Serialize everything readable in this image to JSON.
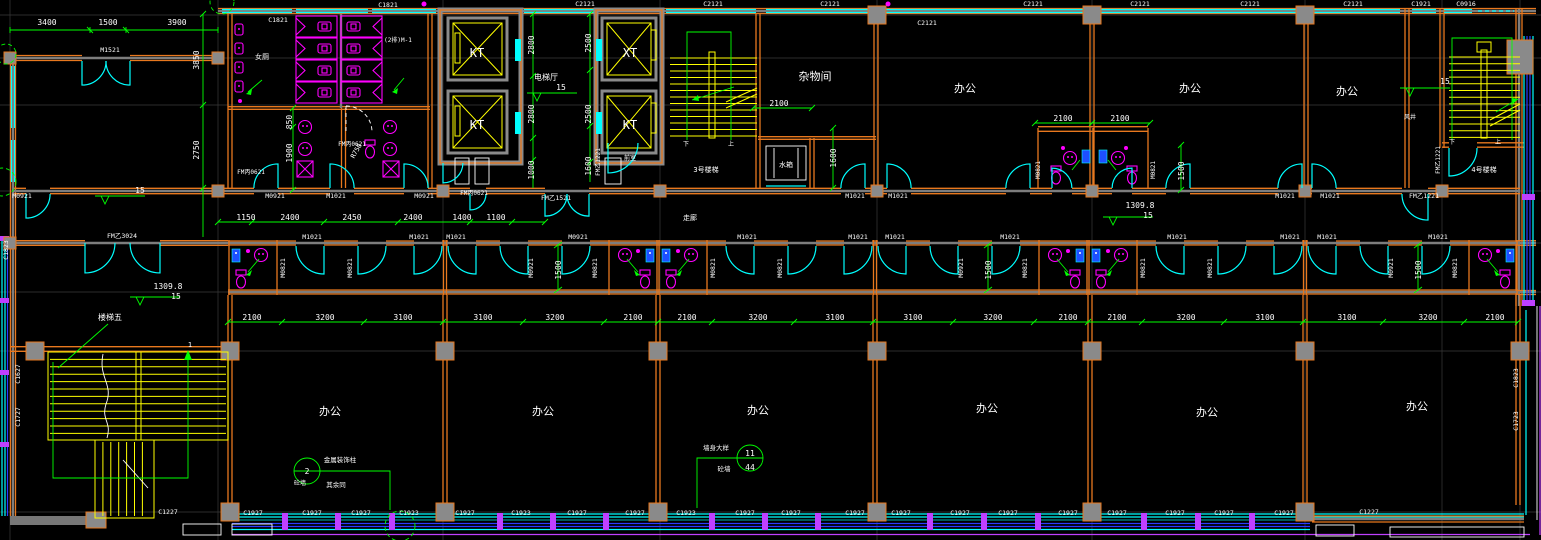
{
  "palette": {
    "background": "#000000",
    "wall_orange": "#E8781E",
    "wall_core_gray": "#8A8A8A",
    "window_cyan": "#00FFFF",
    "fixture_magenta": "#FF00FF",
    "dimension_green": "#00FF00",
    "stair_yellow": "#FFFF00",
    "text_white": "#FFFFFF",
    "curtain_blue": "#2B3BFF",
    "mullion_purple": "#BF40FF"
  },
  "drawing": {
    "type": "architectural-floor-plan",
    "rooms": [
      "办公",
      "杂物间",
      "电梯厅",
      "走廊",
      "水箱",
      "前室",
      "女厕",
      "风井",
      "3号楼梯",
      "4号楼梯",
      "楼梯五"
    ]
  },
  "labels": [
    {
      "t": "杂物间",
      "x": 815,
      "y": 80,
      "s": 11
    },
    {
      "t": "办公",
      "x": 965,
      "y": 92,
      "s": 11
    },
    {
      "t": "办公",
      "x": 1190,
      "y": 92,
      "s": 11
    },
    {
      "t": "办公",
      "x": 1347,
      "y": 95,
      "s": 11
    },
    {
      "t": "办公",
      "x": 330,
      "y": 415,
      "s": 11
    },
    {
      "t": "办公",
      "x": 543,
      "y": 415,
      "s": 11
    },
    {
      "t": "办公",
      "x": 758,
      "y": 414,
      "s": 11
    },
    {
      "t": "办公",
      "x": 987,
      "y": 412,
      "s": 11
    },
    {
      "t": "办公",
      "x": 1207,
      "y": 416,
      "s": 11
    },
    {
      "t": "办公",
      "x": 1417,
      "y": 410,
      "s": 11
    },
    {
      "t": "电梯厅",
      "x": 546,
      "y": 80,
      "s": 8
    },
    {
      "t": "3号楼梯",
      "x": 706,
      "y": 172,
      "s": 7
    },
    {
      "t": "4号楼梯",
      "x": 1484,
      "y": 172,
      "s": 7
    },
    {
      "t": "楼梯五",
      "x": 110,
      "y": 320,
      "s": 8
    },
    {
      "t": "水箱",
      "x": 786,
      "y": 167,
      "s": 7
    },
    {
      "t": "走廊",
      "x": 690,
      "y": 220,
      "s": 7
    },
    {
      "t": "女厕",
      "x": 262,
      "y": 59,
      "s": 7
    },
    {
      "t": "前室",
      "x": 630,
      "y": 160,
      "s": 6
    },
    {
      "t": "风井",
      "x": 1410,
      "y": 119,
      "s": 6
    },
    {
      "t": "(2排)M-1",
      "x": 398,
      "y": 42,
      "s": 6
    },
    {
      "t": "下",
      "x": 686,
      "y": 146,
      "s": 6
    },
    {
      "t": "上",
      "x": 731,
      "y": 146,
      "s": 6
    },
    {
      "t": "下",
      "x": 1452,
      "y": 144,
      "s": 6
    },
    {
      "t": "上",
      "x": 1498,
      "y": 144,
      "s": 6
    },
    {
      "t": "1",
      "x": 190,
      "y": 347,
      "s": 7
    },
    {
      "t": "KT",
      "x": 477,
      "y": 57,
      "s": 12
    },
    {
      "t": "KT",
      "x": 477,
      "y": 129,
      "s": 12
    },
    {
      "t": "XT",
      "x": 630,
      "y": 57,
      "s": 12
    },
    {
      "t": "KT",
      "x": 630,
      "y": 129,
      "s": 12
    },
    {
      "t": "3400",
      "x": 47,
      "y": 25
    },
    {
      "t": "1500",
      "x": 108,
      "y": 25
    },
    {
      "t": "3900",
      "x": 177,
      "y": 25
    },
    {
      "t": "1150",
      "x": 246,
      "y": 220
    },
    {
      "t": "2400",
      "x": 290,
      "y": 220
    },
    {
      "t": "2450",
      "x": 352,
      "y": 220
    },
    {
      "t": "2400",
      "x": 413,
      "y": 220
    },
    {
      "t": "1400",
      "x": 462,
      "y": 220
    },
    {
      "t": "1100",
      "x": 496,
      "y": 220
    },
    {
      "t": "2100",
      "x": 252,
      "y": 320
    },
    {
      "t": "3200",
      "x": 325,
      "y": 320
    },
    {
      "t": "3100",
      "x": 403,
      "y": 320
    },
    {
      "t": "3100",
      "x": 483,
      "y": 320
    },
    {
      "t": "3200",
      "x": 555,
      "y": 320
    },
    {
      "t": "2100",
      "x": 633,
      "y": 320
    },
    {
      "t": "2100",
      "x": 687,
      "y": 320
    },
    {
      "t": "3200",
      "x": 758,
      "y": 320
    },
    {
      "t": "3100",
      "x": 835,
      "y": 320
    },
    {
      "t": "3100",
      "x": 913,
      "y": 320
    },
    {
      "t": "3200",
      "x": 993,
      "y": 320
    },
    {
      "t": "2100",
      "x": 1068,
      "y": 320
    },
    {
      "t": "2100",
      "x": 1117,
      "y": 320
    },
    {
      "t": "3200",
      "x": 1186,
      "y": 320
    },
    {
      "t": "3100",
      "x": 1265,
      "y": 320
    },
    {
      "t": "3100",
      "x": 1347,
      "y": 320
    },
    {
      "t": "3200",
      "x": 1428,
      "y": 320
    },
    {
      "t": "2100",
      "x": 1495,
      "y": 320
    },
    {
      "t": "2100",
      "x": 779,
      "y": 106
    },
    {
      "t": "2100",
      "x": 1063,
      "y": 121
    },
    {
      "t": "2100",
      "x": 1120,
      "y": 121
    },
    {
      "t": "15",
      "x": 140,
      "y": 193
    },
    {
      "t": "15",
      "x": 561,
      "y": 90
    },
    {
      "t": "15",
      "x": 1445,
      "y": 84
    },
    {
      "t": "1309.8",
      "x": 168,
      "y": 289
    },
    {
      "t": "15",
      "x": 176,
      "y": 299
    },
    {
      "t": "1309.8",
      "x": 1140,
      "y": 208
    },
    {
      "t": "15",
      "x": 1148,
      "y": 218
    },
    {
      "t": "3850",
      "x": 199,
      "y": 60,
      "r": -90
    },
    {
      "t": "2750",
      "x": 199,
      "y": 150,
      "r": -90
    },
    {
      "t": "2800",
      "x": 534,
      "y": 45,
      "r": -90
    },
    {
      "t": "2800",
      "x": 534,
      "y": 114,
      "r": -90
    },
    {
      "t": "1000",
      "x": 534,
      "y": 170,
      "r": -90
    },
    {
      "t": "2500",
      "x": 591,
      "y": 43,
      "r": -90
    },
    {
      "t": "2500",
      "x": 591,
      "y": 114,
      "r": -90
    },
    {
      "t": "1600",
      "x": 591,
      "y": 166,
      "r": -90
    },
    {
      "t": "850",
      "x": 292,
      "y": 122,
      "r": -90
    },
    {
      "t": "1900",
      "x": 292,
      "y": 153,
      "r": -90
    },
    {
      "t": "1600",
      "x": 836,
      "y": 158,
      "r": -90
    },
    {
      "t": "1500",
      "x": 561,
      "y": 270,
      "r": -90
    },
    {
      "t": "1500",
      "x": 991,
      "y": 270,
      "r": -90
    },
    {
      "t": "1500",
      "x": 1421,
      "y": 270,
      "r": -90
    },
    {
      "t": "1500",
      "x": 1184,
      "y": 171,
      "r": -90
    },
    {
      "t": "R750",
      "x": 358,
      "y": 152,
      "s": 6.5,
      "r": -60
    },
    {
      "t": "M1521",
      "x": 110,
      "y": 52,
      "s": 6.5
    },
    {
      "t": "C1821",
      "x": 278,
      "y": 22,
      "s": 6.5
    },
    {
      "t": "C1821",
      "x": 388,
      "y": 7,
      "s": 6.5
    },
    {
      "t": "C2121",
      "x": 585,
      "y": 6,
      "s": 6.5
    },
    {
      "t": "C2121",
      "x": 713,
      "y": 6,
      "s": 6.5
    },
    {
      "t": "C2121",
      "x": 830,
      "y": 6,
      "s": 6.5
    },
    {
      "t": "C2121",
      "x": 927,
      "y": 25,
      "s": 6.5
    },
    {
      "t": "C2121",
      "x": 1033,
      "y": 6,
      "s": 6.5
    },
    {
      "t": "C2121",
      "x": 1140,
      "y": 6,
      "s": 6.5
    },
    {
      "t": "C2121",
      "x": 1250,
      "y": 6,
      "s": 6.5
    },
    {
      "t": "C2121",
      "x": 1353,
      "y": 6,
      "s": 6.5
    },
    {
      "t": "C1921",
      "x": 1421,
      "y": 6,
      "s": 6.5
    },
    {
      "t": "C0916",
      "x": 1466,
      "y": 6,
      "s": 6.5
    },
    {
      "t": "C1227",
      "x": 168,
      "y": 514,
      "s": 6.5
    },
    {
      "t": "C1927",
      "x": 253,
      "y": 515,
      "s": 6.5
    },
    {
      "t": "C1927",
      "x": 312,
      "y": 515,
      "s": 6.5
    },
    {
      "t": "C1927",
      "x": 361,
      "y": 515,
      "s": 6.5
    },
    {
      "t": "C1923",
      "x": 409,
      "y": 515,
      "s": 6.5
    },
    {
      "t": "C1927",
      "x": 465,
      "y": 515,
      "s": 6.5
    },
    {
      "t": "C1923",
      "x": 521,
      "y": 515,
      "s": 6.5
    },
    {
      "t": "C1927",
      "x": 577,
      "y": 515,
      "s": 6.5
    },
    {
      "t": "C1927",
      "x": 635,
      "y": 515,
      "s": 6.5
    },
    {
      "t": "C1923",
      "x": 686,
      "y": 515,
      "s": 6.5
    },
    {
      "t": "C1927",
      "x": 745,
      "y": 515,
      "s": 6.5
    },
    {
      "t": "C1927",
      "x": 791,
      "y": 515,
      "s": 6.5
    },
    {
      "t": "C1927",
      "x": 855,
      "y": 515,
      "s": 6.5
    },
    {
      "t": "C1927",
      "x": 901,
      "y": 515,
      "s": 6.5
    },
    {
      "t": "C1927",
      "x": 960,
      "y": 515,
      "s": 6.5
    },
    {
      "t": "C1927",
      "x": 1008,
      "y": 515,
      "s": 6.5
    },
    {
      "t": "C1927",
      "x": 1068,
      "y": 515,
      "s": 6.5
    },
    {
      "t": "C1927",
      "x": 1117,
      "y": 515,
      "s": 6.5
    },
    {
      "t": "C1927",
      "x": 1175,
      "y": 515,
      "s": 6.5
    },
    {
      "t": "C1927",
      "x": 1224,
      "y": 515,
      "s": 6.5
    },
    {
      "t": "C1927",
      "x": 1284,
      "y": 515,
      "s": 6.5
    },
    {
      "t": "C1227",
      "x": 1369,
      "y": 514,
      "s": 6.5
    },
    {
      "t": "C1823",
      "x": 8,
      "y": 250,
      "s": 6.5,
      "r": -90
    },
    {
      "t": "C1627",
      "x": 20,
      "y": 374,
      "s": 6.5,
      "r": -90
    },
    {
      "t": "C1727",
      "x": 20,
      "y": 417,
      "s": 6.5,
      "r": -90
    },
    {
      "t": "C1823",
      "x": 1518,
      "y": 378,
      "s": 6.5,
      "r": -90
    },
    {
      "t": "C1723",
      "x": 1518,
      "y": 421,
      "s": 6.5,
      "r": -90
    },
    {
      "t": "M0921",
      "x": 22,
      "y": 198,
      "s": 6.5
    },
    {
      "t": "M0921",
      "x": 275,
      "y": 198,
      "s": 6.5
    },
    {
      "t": "M1021",
      "x": 336,
      "y": 198,
      "s": 6.5
    },
    {
      "t": "M0921",
      "x": 424,
      "y": 198,
      "s": 6.5
    },
    {
      "t": "FM丙0621",
      "x": 474,
      "y": 195,
      "s": 6
    },
    {
      "t": "FM乙1521",
      "x": 556,
      "y": 200,
      "s": 6.5
    },
    {
      "t": "M1021",
      "x": 855,
      "y": 198,
      "s": 6.5
    },
    {
      "t": "M1021",
      "x": 898,
      "y": 198,
      "s": 6.5
    },
    {
      "t": "M1021",
      "x": 1285,
      "y": 198,
      "s": 6.5
    },
    {
      "t": "M1021",
      "x": 1330,
      "y": 198,
      "s": 6.5
    },
    {
      "t": "FM乙1221",
      "x": 1424,
      "y": 198,
      "s": 6.5
    },
    {
      "t": "M1021",
      "x": 312,
      "y": 239,
      "s": 6.5
    },
    {
      "t": "M1021",
      "x": 419,
      "y": 239,
      "s": 6.5
    },
    {
      "t": "M1021",
      "x": 456,
      "y": 239,
      "s": 6.5
    },
    {
      "t": "M0921",
      "x": 578,
      "y": 239,
      "s": 6.5
    },
    {
      "t": "M1021",
      "x": 747,
      "y": 239,
      "s": 6.5
    },
    {
      "t": "M1021",
      "x": 858,
      "y": 239,
      "s": 6.5
    },
    {
      "t": "M1021",
      "x": 895,
      "y": 239,
      "s": 6.5
    },
    {
      "t": "M1021",
      "x": 1010,
      "y": 239,
      "s": 6.5
    },
    {
      "t": "M1021",
      "x": 1177,
      "y": 239,
      "s": 6.5
    },
    {
      "t": "M1021",
      "x": 1290,
      "y": 239,
      "s": 6.5
    },
    {
      "t": "M1021",
      "x": 1327,
      "y": 239,
      "s": 6.5
    },
    {
      "t": "M1021",
      "x": 1438,
      "y": 239,
      "s": 6.5
    },
    {
      "t": "M0821",
      "x": 285,
      "y": 268,
      "s": 6.5,
      "r": -90
    },
    {
      "t": "M0821",
      "x": 352,
      "y": 268,
      "s": 6.5,
      "r": -90
    },
    {
      "t": "M0921",
      "x": 533,
      "y": 268,
      "s": 6.5,
      "r": -90
    },
    {
      "t": "M0821",
      "x": 597,
      "y": 268,
      "s": 6.5,
      "r": -90
    },
    {
      "t": "M0821",
      "x": 715,
      "y": 268,
      "s": 6.5,
      "r": -90
    },
    {
      "t": "M0821",
      "x": 782,
      "y": 268,
      "s": 6.5,
      "r": -90
    },
    {
      "t": "M0921",
      "x": 963,
      "y": 268,
      "s": 6.5,
      "r": -90
    },
    {
      "t": "M0821",
      "x": 1027,
      "y": 268,
      "s": 6.5,
      "r": -90
    },
    {
      "t": "M0821",
      "x": 1145,
      "y": 268,
      "s": 6.5,
      "r": -90
    },
    {
      "t": "M0821",
      "x": 1212,
      "y": 268,
      "s": 6.5,
      "r": -90
    },
    {
      "t": "M0921",
      "x": 1393,
      "y": 268,
      "s": 6.5,
      "r": -90
    },
    {
      "t": "M0821",
      "x": 1457,
      "y": 268,
      "s": 6.5,
      "r": -90
    },
    {
      "t": "FM乙1221",
      "x": 600,
      "y": 162,
      "s": 6,
      "r": -90
    },
    {
      "t": "FM乙1221",
      "x": 1440,
      "y": 160,
      "s": 6,
      "r": -90
    },
    {
      "t": "M0821",
      "x": 1040,
      "y": 170,
      "s": 6,
      "r": -90
    },
    {
      "t": "M0821",
      "x": 1155,
      "y": 170,
      "s": 6,
      "r": -90
    },
    {
      "t": "FM乙3024",
      "x": 122,
      "y": 238,
      "s": 6.5
    },
    {
      "t": "FM丙0621",
      "x": 251,
      "y": 174,
      "s": 6
    },
    {
      "t": "FM丙0621",
      "x": 352,
      "y": 146,
      "s": 6
    },
    {
      "t": "2",
      "x": 307,
      "y": 474,
      "s": 8
    },
    {
      "t": "砼墙",
      "x": 300,
      "y": 485,
      "s": 6
    },
    {
      "t": "金属装饰柱",
      "x": 340,
      "y": 462,
      "s": 6.5
    },
    {
      "t": "其余同",
      "x": 336,
      "y": 487,
      "s": 6.5
    },
    {
      "t": "11",
      "x": 750,
      "y": 456,
      "s": 8
    },
    {
      "t": "44",
      "x": 750,
      "y": 470,
      "s": 8
    },
    {
      "t": "墙身大样",
      "x": 716,
      "y": 450,
      "s": 6.5
    },
    {
      "t": "砼墙",
      "x": 724,
      "y": 471,
      "s": 6.5
    }
  ]
}
